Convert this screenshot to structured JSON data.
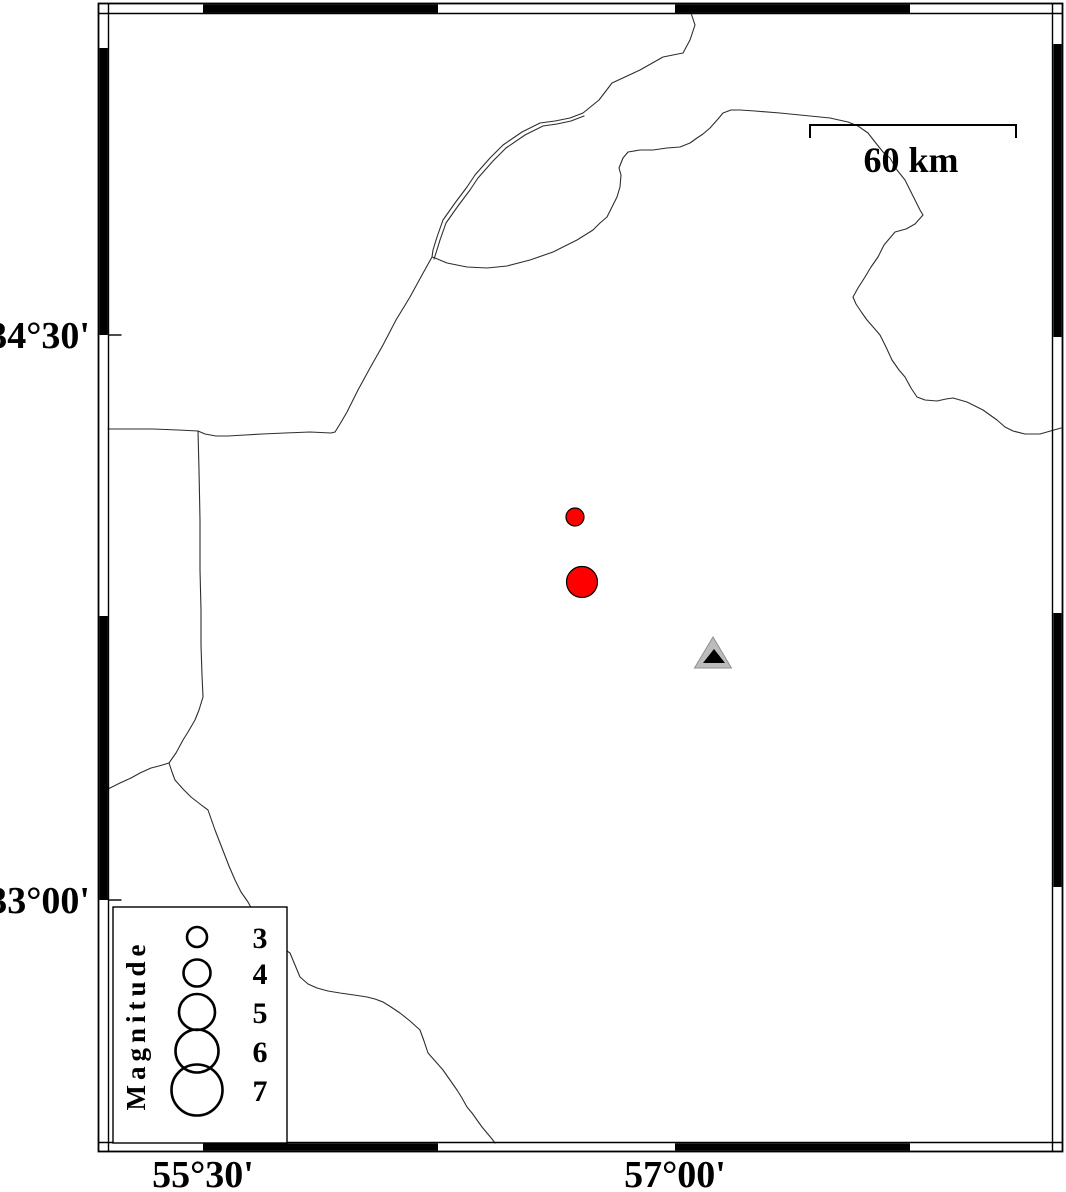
{
  "figure": {
    "width": 1066,
    "height": 1192,
    "background": "#ffffff"
  },
  "map_frame": {
    "outer": {
      "x1": 98.5,
      "y1": 3.5,
      "x2": 1062.5,
      "y2": 1151.5
    },
    "inner": {
      "x1": 108.5,
      "y1": 13.5,
      "x2": 1052.5,
      "y2": 1142.5
    },
    "black_segments": {
      "top": [
        [
          203,
          438
        ],
        [
          675,
          910
        ]
      ],
      "bottom": [
        [
          203,
          438
        ],
        [
          675,
          910
        ]
      ],
      "left": [
        [
          48,
          335
        ],
        [
          616,
          900
        ]
      ],
      "right": [
        [
          44,
          337
        ],
        [
          613,
          887
        ]
      ]
    },
    "left_tick_length": 13
  },
  "axis_labels": {
    "left": [
      {
        "text": "34°30'",
        "y": 335
      },
      {
        "text": "33°00'",
        "y": 900
      }
    ],
    "bottom": [
      {
        "text": "55°30'",
        "x": 203
      },
      {
        "text": "57°00'",
        "x": 675
      }
    ]
  },
  "scale_bar": {
    "label": "60 km",
    "x1": 810,
    "x2": 1016,
    "y": 125,
    "tick_drop": 13,
    "label_x": 911,
    "label_y": 172
  },
  "legend": {
    "title": "Magnitude",
    "box": {
      "x": 113,
      "y": 907,
      "w": 174,
      "h": 236
    },
    "title_x": 145,
    "title_y": 1025,
    "circle_x": 197,
    "value_x": 260,
    "entries": [
      {
        "magnitude": "3",
        "r": 10,
        "cy": 937
      },
      {
        "magnitude": "4",
        "r": 13.5,
        "cy": 973
      },
      {
        "magnitude": "5",
        "r": 18,
        "cy": 1012
      },
      {
        "magnitude": "6",
        "r": 21.5,
        "cy": 1051
      },
      {
        "magnitude": "7",
        "r": 25.5,
        "cy": 1090
      }
    ]
  },
  "earthquakes": {
    "fill": "#ff0000",
    "stroke": "#000000",
    "points": [
      {
        "x": 575,
        "y": 517,
        "r": 9
      },
      {
        "x": 582,
        "y": 582,
        "r": 15.5
      }
    ]
  },
  "station": {
    "outer": {
      "apex_x": 713,
      "apex_y": 637,
      "base_y": 668,
      "half_w": 18.5,
      "fill": "#bcbcbc",
      "stroke": "#8f8f8f"
    },
    "inner": {
      "apex_x": 714,
      "apex_y": 649,
      "base_y": 663,
      "half_w": 11,
      "fill": "#000000"
    }
  },
  "boundaries": {
    "color": "#2e2e2e",
    "width": 1.1,
    "polylines": [
      [
        [
          691,
          13
        ],
        [
          695,
          25
        ],
        [
          690,
          40
        ],
        [
          683,
          53
        ],
        [
          663,
          57
        ],
        [
          640,
          70
        ],
        [
          612,
          83
        ],
        [
          599,
          100
        ],
        [
          583,
          113
        ],
        [
          570,
          118
        ],
        [
          555,
          121
        ],
        [
          540,
          123
        ],
        [
          522,
          132
        ],
        [
          503,
          145
        ],
        [
          490,
          158
        ],
        [
          475,
          175
        ],
        [
          467,
          187
        ],
        [
          455,
          203
        ],
        [
          443,
          220
        ],
        [
          437,
          237
        ],
        [
          433,
          250
        ],
        [
          432,
          257
        ],
        [
          422,
          275
        ],
        [
          410,
          297
        ],
        [
          396,
          320
        ],
        [
          383,
          345
        ],
        [
          370,
          368
        ],
        [
          358,
          390
        ],
        [
          347,
          412
        ],
        [
          340,
          424
        ],
        [
          335,
          432
        ]
      ],
      [
        [
          584,
          116
        ],
        [
          571,
          121
        ],
        [
          557,
          124
        ],
        [
          543,
          126
        ],
        [
          525,
          135
        ],
        [
          506,
          148
        ],
        [
          493,
          161
        ],
        [
          478,
          178
        ],
        [
          470,
          190
        ],
        [
          458,
          206
        ],
        [
          446,
          223
        ],
        [
          440,
          240
        ],
        [
          436,
          253
        ],
        [
          434,
          259
        ]
      ],
      [
        [
          432,
          257
        ],
        [
          435,
          258
        ],
        [
          447,
          263
        ],
        [
          467,
          267
        ],
        [
          487,
          268
        ],
        [
          507,
          266
        ],
        [
          530,
          260
        ],
        [
          553,
          252
        ],
        [
          577,
          240
        ],
        [
          593,
          230
        ],
        [
          600,
          223
        ],
        [
          607,
          217
        ],
        [
          613,
          205
        ],
        [
          617,
          197
        ],
        [
          620,
          187
        ],
        [
          621,
          175
        ],
        [
          619,
          168
        ],
        [
          623,
          158
        ],
        [
          628,
          152
        ],
        [
          640,
          150
        ],
        [
          653,
          150
        ],
        [
          667,
          148
        ],
        [
          680,
          147
        ],
        [
          690,
          143
        ],
        [
          697,
          138
        ],
        [
          703,
          134
        ],
        [
          710,
          128
        ],
        [
          718,
          119
        ],
        [
          723,
          113
        ],
        [
          731,
          110
        ],
        [
          740,
          110
        ],
        [
          755,
          111
        ],
        [
          780,
          113
        ],
        [
          800,
          115
        ],
        [
          830,
          118
        ],
        [
          848,
          122
        ],
        [
          858,
          126
        ],
        [
          868,
          133
        ],
        [
          875,
          142
        ],
        [
          883,
          152
        ],
        [
          890,
          158
        ],
        [
          897,
          170
        ],
        [
          905,
          180
        ],
        [
          913,
          196
        ],
        [
          920,
          210
        ],
        [
          923,
          215
        ],
        [
          915,
          224
        ],
        [
          906,
          229
        ],
        [
          895,
          232
        ],
        [
          884,
          245
        ],
        [
          878,
          257
        ],
        [
          871,
          267
        ],
        [
          865,
          277
        ],
        [
          858,
          288
        ],
        [
          853,
          297
        ],
        [
          856,
          304
        ],
        [
          862,
          313
        ],
        [
          867,
          320
        ],
        [
          874,
          328
        ],
        [
          880,
          335
        ],
        [
          886,
          347
        ],
        [
          892,
          360
        ],
        [
          899,
          370
        ],
        [
          905,
          377
        ],
        [
          911,
          388
        ],
        [
          917,
          397
        ],
        [
          925,
          400
        ],
        [
          937,
          401
        ],
        [
          946,
          399
        ],
        [
          953,
          398
        ],
        [
          960,
          400
        ],
        [
          967,
          402
        ],
        [
          975,
          406
        ],
        [
          983,
          410
        ],
        [
          990,
          415
        ],
        [
          997,
          420
        ],
        [
          1005,
          427
        ],
        [
          1013,
          431
        ],
        [
          1025,
          434
        ],
        [
          1040,
          434
        ],
        [
          1061,
          428
        ]
      ],
      [
        [
          108,
          429
        ],
        [
          130,
          429
        ],
        [
          153,
          429
        ],
        [
          178,
          430
        ],
        [
          198,
          431
        ],
        [
          205,
          434
        ],
        [
          216,
          436
        ],
        [
          228,
          436
        ],
        [
          245,
          435
        ],
        [
          262,
          434
        ],
        [
          285,
          433
        ],
        [
          310,
          432
        ],
        [
          331,
          433
        ],
        [
          335,
          432
        ]
      ],
      [
        [
          198,
          431
        ],
        [
          199,
          470
        ],
        [
          200,
          520
        ],
        [
          200,
          570
        ],
        [
          201,
          610
        ],
        [
          201,
          645
        ],
        [
          202,
          675
        ],
        [
          203,
          697
        ],
        [
          199,
          710
        ],
        [
          195,
          720
        ],
        [
          188,
          732
        ],
        [
          183,
          740
        ],
        [
          176,
          753
        ],
        [
          169,
          763
        ]
      ],
      [
        [
          169,
          763
        ],
        [
          159,
          766
        ],
        [
          151,
          768
        ],
        [
          140,
          773
        ],
        [
          131,
          778
        ],
        [
          120,
          783
        ],
        [
          108,
          789
        ]
      ],
      [
        [
          169,
          763
        ],
        [
          172,
          772
        ],
        [
          175,
          780
        ],
        [
          183,
          789
        ],
        [
          191,
          797
        ],
        [
          200,
          804
        ],
        [
          208,
          810
        ],
        [
          215,
          830
        ],
        [
          222,
          848
        ],
        [
          229,
          866
        ],
        [
          235,
          880
        ],
        [
          241,
          892
        ],
        [
          248,
          902
        ],
        [
          255,
          915
        ],
        [
          262,
          925
        ],
        [
          271,
          937
        ],
        [
          281,
          947
        ],
        [
          290,
          953
        ],
        [
          295,
          965
        ],
        [
          300,
          977
        ],
        [
          308,
          984
        ],
        [
          317,
          988
        ],
        [
          328,
          991
        ],
        [
          340,
          993
        ],
        [
          354,
          995
        ],
        [
          367,
          997
        ],
        [
          375,
          999
        ],
        [
          383,
          1002
        ],
        [
          391,
          1007
        ],
        [
          400,
          1013
        ],
        [
          410,
          1021
        ],
        [
          420,
          1030
        ],
        [
          424,
          1041
        ],
        [
          428,
          1053
        ],
        [
          436,
          1062
        ],
        [
          443,
          1070
        ],
        [
          450,
          1080
        ],
        [
          457,
          1090
        ],
        [
          462,
          1098
        ],
        [
          467,
          1107
        ],
        [
          472,
          1113
        ],
        [
          477,
          1120
        ],
        [
          482,
          1127
        ],
        [
          487,
          1133
        ],
        [
          492,
          1139
        ],
        [
          495,
          1143
        ]
      ]
    ]
  }
}
